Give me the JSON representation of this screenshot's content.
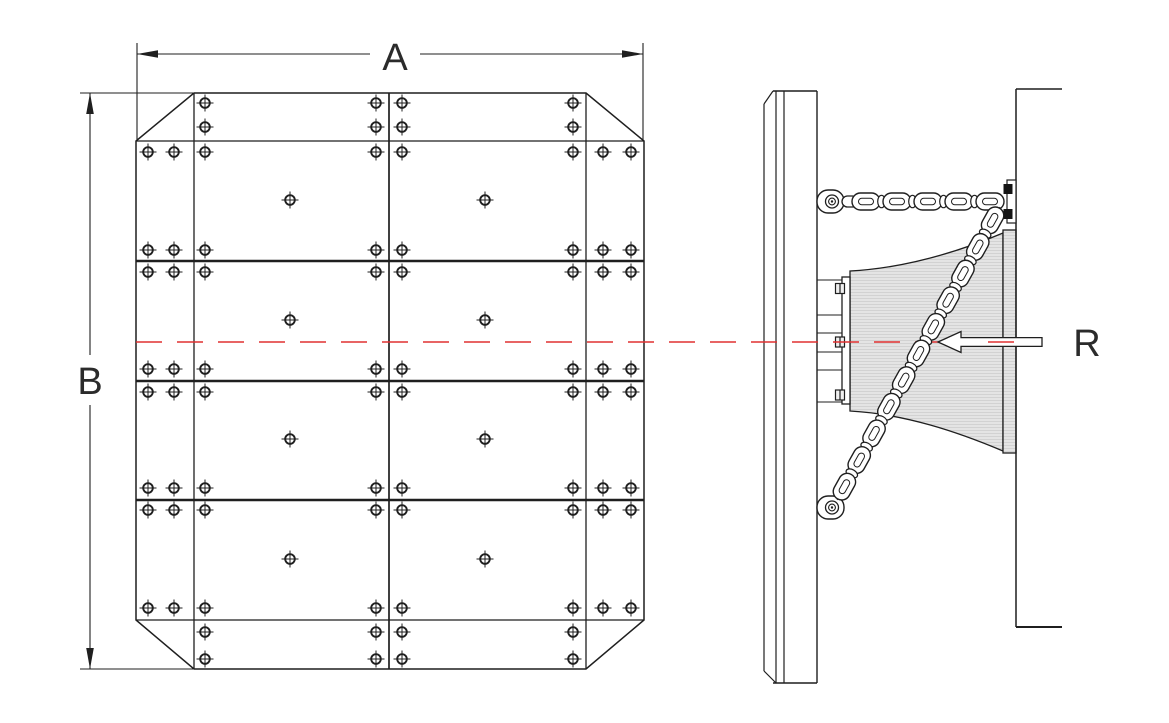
{
  "drawing": {
    "title": "Cone fender with frontal panel - general arrangement drawing",
    "labels": {
      "width_dim": "A",
      "height_dim": "B",
      "reaction_force": "R"
    },
    "colors": {
      "line": "#1f1f1f",
      "centerline": "#e03030",
      "fender_fill": "#e4e4e4",
      "fender_stripe": "#d2d2d2",
      "background": "#ffffff"
    },
    "front_view": {
      "panel_left": 136,
      "panel_right": 644,
      "panel_top": 93,
      "panel_bottom": 669,
      "bolt_columns_full": [
        148,
        174,
        205,
        376,
        402,
        573,
        603,
        631
      ],
      "bolt_rows_full": [
        152,
        250,
        272,
        369,
        392,
        488,
        510,
        608
      ],
      "bolt_columns_strip": [
        205,
        376,
        402,
        573
      ],
      "bolt_rows_strip": [
        103,
        127,
        632,
        659
      ],
      "center_bolt_columns": [
        290,
        485
      ],
      "center_bolt_rows": [
        200,
        320,
        439,
        559
      ]
    },
    "side_view": {
      "centerline_y": 342,
      "chain_top": {
        "x_start": 848,
        "x_end": 1000,
        "y": 201.5,
        "links": 5
      },
      "chain_diagonal": {
        "x1": 1000,
        "y1": 207,
        "x2": 837,
        "y2": 500,
        "links": 11
      }
    }
  }
}
